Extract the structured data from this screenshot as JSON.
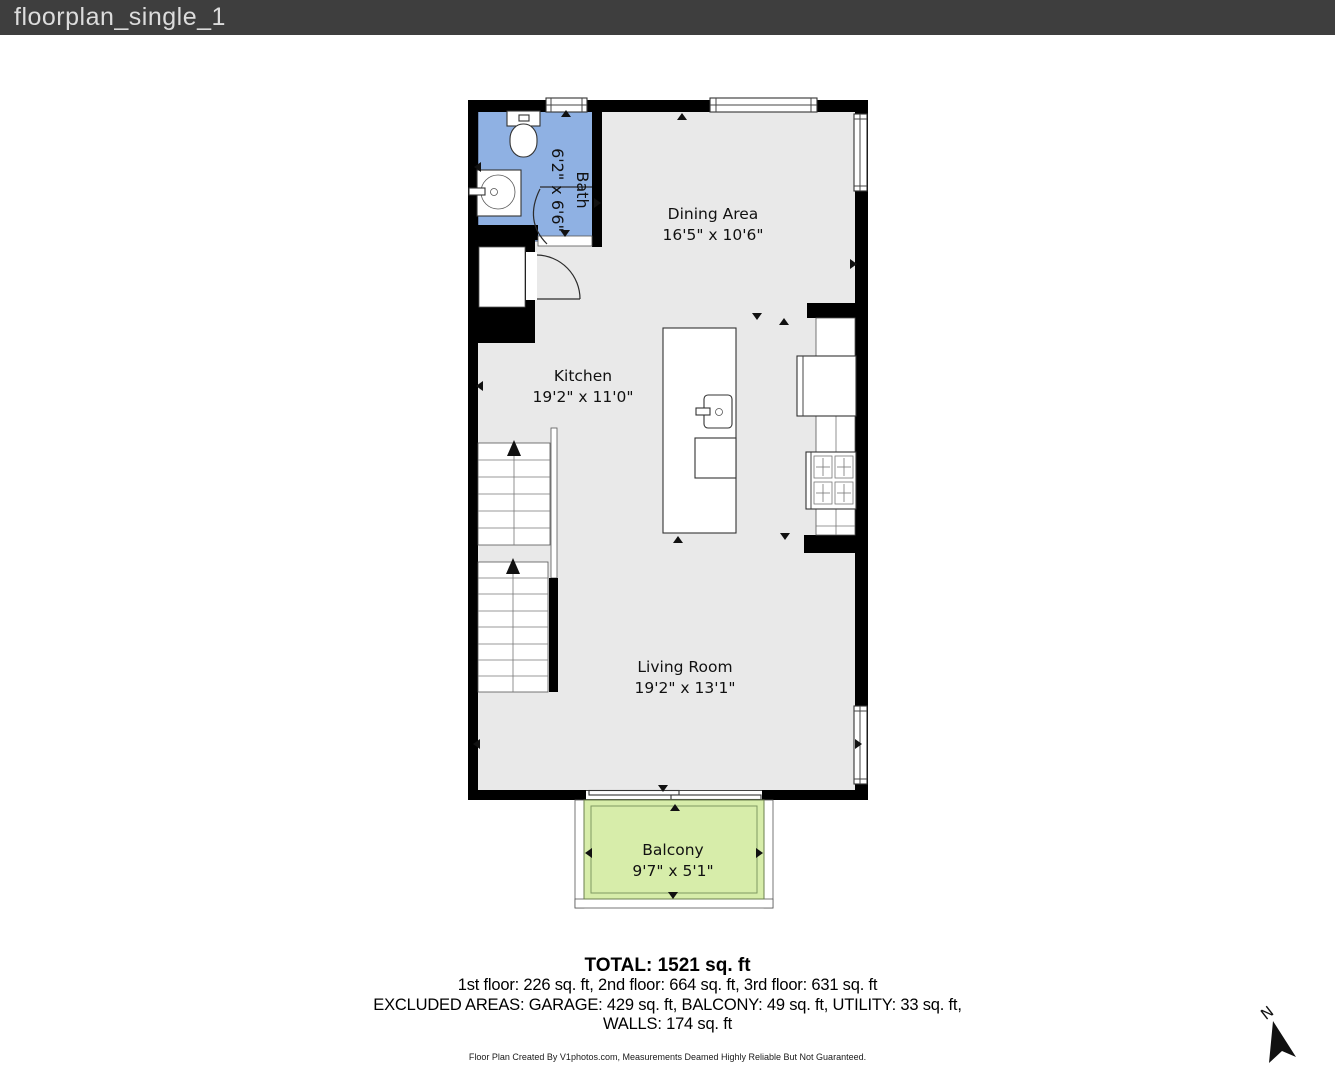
{
  "header": {
    "title": "floorplan_single_1"
  },
  "rooms": {
    "bath": {
      "name": "Bath",
      "dims": "6'2\" x 6'6\""
    },
    "dining": {
      "name": "Dining Area",
      "dims": "16'5\" x 10'6\""
    },
    "kitchen": {
      "name": "Kitchen",
      "dims": "19'2\" x 11'0\""
    },
    "living": {
      "name": "Living Room",
      "dims": "19'2\" x 13'1\""
    },
    "balcony": {
      "name": "Balcony",
      "dims": "9'7\" x 5'1\""
    }
  },
  "summary": {
    "total": "TOTAL: 1521 sq. ft",
    "floors": "1st floor: 226 sq. ft, 2nd floor: 664 sq. ft, 3rd floor: 631 sq. ft",
    "excluded": "EXCLUDED AREAS: GARAGE: 429 sq. ft, BALCONY: 49 sq. ft, UTILITY: 33 sq. ft,",
    "walls": "WALLS: 174 sq. ft",
    "disclaimer": "Floor Plan Created By V1photos.com, Measurements Deamed Highly Reliable But Not Guaranteed."
  },
  "compass": {
    "label": "N"
  },
  "colors": {
    "titlebar": "#3e3e3e",
    "titletext": "#dcdcdc",
    "wall": "#000000",
    "floor": "#e9e9e9",
    "bath": "#8fb1e3",
    "balcony": "#d7edaa"
  }
}
